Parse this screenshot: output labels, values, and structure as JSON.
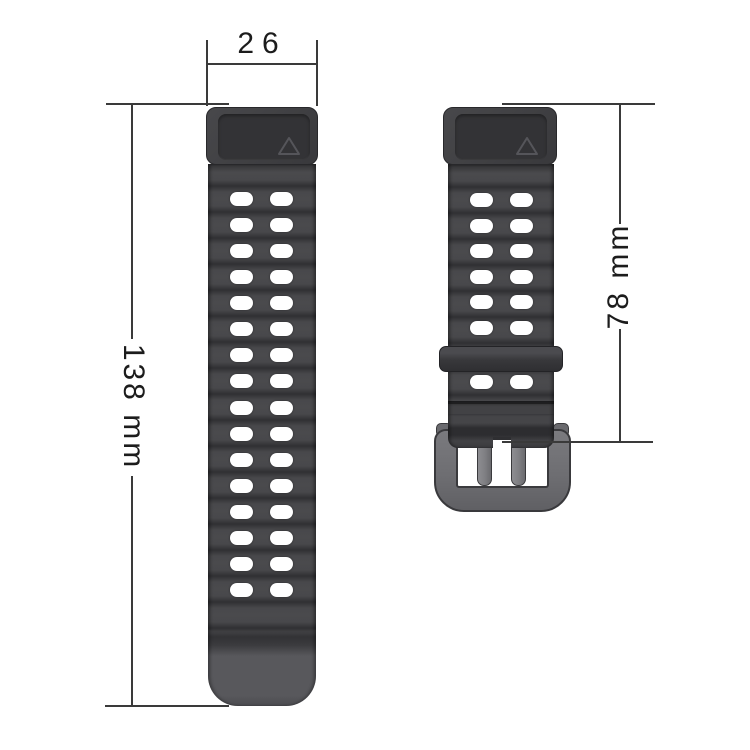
{
  "labels": {
    "lug_width": "26",
    "long_strap_length": "138 mm",
    "short_strap_length": "78 mm"
  },
  "straps": {
    "long": {
      "hole_rows": 16,
      "hole_cols": 2
    },
    "short": {
      "hole_rows_above_keeper": 6,
      "hole_rows_below_keeper": 1,
      "hole_cols": 2
    }
  },
  "icons": {
    "connector_mark": "triangle-outline"
  },
  "colors": {
    "background": "#ffffff",
    "dimension_line": "#3a3a3a",
    "label_text": "#1c1c1c",
    "strap_light": "#4a4a4d",
    "strap_dark": "#303033",
    "connector": "#3e3e41",
    "connector_inset": "#333336",
    "triangle_outline": "#55555a",
    "tip": "#58585c",
    "keeper": "#3d3d40",
    "buckle_frame": "#6e6e72",
    "buckle_prong": "#7e7e82",
    "hole": "#ffffff"
  }
}
